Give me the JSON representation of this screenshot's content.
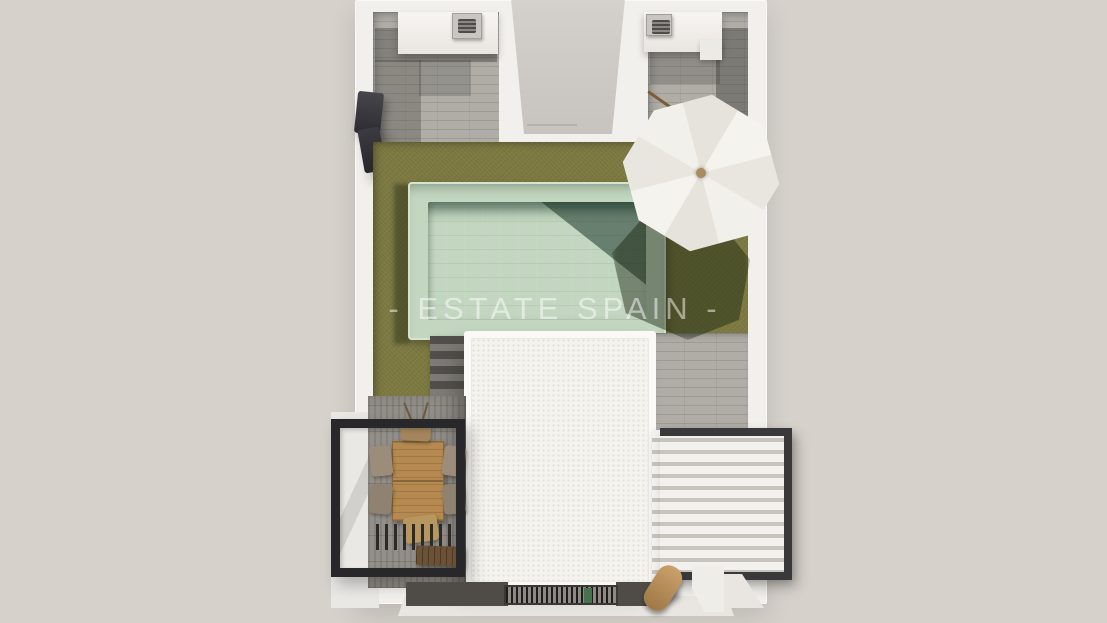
{
  "watermark": {
    "text": "- ESTATE SPAIN -"
  },
  "colors": {
    "background": "#d6d1cb",
    "wall": "#f2f0ec",
    "wallShade": "#e9e6e1",
    "tile": "#b0ada7",
    "grass": "#7d7a42",
    "poolBorder": "#c3d6c0",
    "poolWater": "#97c3ad",
    "poolShadow": "#2f5a49",
    "roof": "#f5f3ee",
    "frame": "#28282a",
    "frameRight": "#39393b",
    "louver": "#f3f1ed",
    "louverGap": "#c7c3bd",
    "wood": "#b5894f",
    "woodDark": "#6b5236",
    "concrete": "#928e88",
    "walkway": "#4f4c48",
    "greenItem": "#47714f",
    "knob": "#a98c5f",
    "pole": "#7a5c38"
  },
  "scene": {
    "type": "top-down 3d architectural render",
    "objects": [
      "villa-walls",
      "sunken-courtyard",
      "stone-patio-left",
      "stone-patio-right",
      "ac-unit-left",
      "ac-unit-right",
      "barbecue",
      "lawn",
      "swimming-pool",
      "garden-steps",
      "white-roof-terrace",
      "dining-table-set",
      "pergola-frame-left",
      "slatted-pergola-roof",
      "garden-bench",
      "louvered-pergola-right",
      "parasol-umbrella",
      "floor-grate",
      "wooden-lounger"
    ]
  }
}
